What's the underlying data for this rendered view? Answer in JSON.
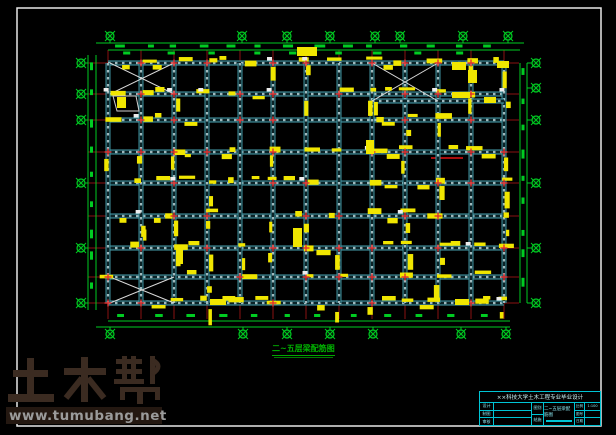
{
  "colors": {
    "background": "#000000",
    "frame": "#e8e8e8",
    "beam_edge": "#48a2b0",
    "beam_dark": "#0b2327",
    "beam_dash": "#9fb9bd",
    "axis_red": "#8a1212",
    "cross_red": "#e23030",
    "green": "#00cc22",
    "yellow": "#f0e600",
    "white_mark": "#ededed",
    "title_green": "#00b400",
    "cyan": "#00c4d4",
    "watermark_brown": "#3b2b21"
  },
  "plan": {
    "frame": {
      "x": 17,
      "y": 8,
      "w": 584,
      "h": 418
    },
    "cols": [
      108,
      141,
      174,
      207,
      240,
      273,
      306,
      339,
      372,
      405,
      438,
      471,
      504
    ],
    "rows": [
      63,
      94,
      120,
      152,
      183,
      216,
      248,
      277,
      303
    ],
    "extra_beams_h": [
      [
        372,
        504,
        101
      ]
    ],
    "red_segments": [
      [
        431,
        102,
        500,
        102
      ],
      [
        431,
        158,
        463,
        158
      ]
    ],
    "braces": [
      [
        110,
        63,
        174,
        94
      ],
      [
        372,
        63,
        438,
        101
      ],
      [
        110,
        277,
        174,
        303
      ]
    ],
    "outline_polys": [
      "M113,96 L136,96 L139,111 L117,111 Z"
    ],
    "bubbles": {
      "top_y": 36,
      "top_x": [
        110,
        242,
        287,
        330,
        375,
        400,
        463,
        508
      ],
      "bottom_y": 334,
      "bottom_x": [
        110,
        243,
        287,
        330,
        373,
        461,
        506
      ],
      "left_x": 81,
      "left_y": [
        63,
        94,
        120,
        183,
        248,
        303
      ],
      "right_x": 536,
      "right_y": [
        63,
        88,
        120,
        183,
        248,
        303
      ]
    },
    "dim": {
      "top": [
        43,
        50
      ],
      "bottom": [
        321,
        327
      ],
      "left": [
        88,
        96
      ],
      "right": [
        520,
        527
      ]
    },
    "extra_callouts": [
      [
        297,
        47,
        20,
        9
      ],
      [
        452,
        62,
        14,
        8
      ],
      [
        468,
        70,
        9,
        13
      ],
      [
        497,
        61,
        12,
        7
      ],
      [
        452,
        92,
        18,
        6
      ],
      [
        484,
        97,
        12,
        6
      ],
      [
        293,
        228,
        9,
        19
      ],
      [
        117,
        97,
        9,
        11
      ],
      [
        176,
        248,
        7,
        16
      ],
      [
        366,
        140,
        8,
        14
      ],
      [
        210,
        299,
        16,
        6
      ],
      [
        455,
        299,
        14,
        6
      ]
    ],
    "texture_seed": 123456
  },
  "drawing_title": {
    "text": "二~五层梁配筋图"
  },
  "watermark": {
    "title": "土木帮",
    "url": "www.tumubang.net"
  },
  "titleblock": {
    "header": "××科技大学土木工程专业毕业设计",
    "left_rows": [
      {
        "label": "设计",
        "value": ""
      },
      {
        "label": "制图",
        "value": ""
      },
      {
        "label": "审核",
        "value": ""
      }
    ],
    "mid_cells": [
      "图别",
      "结施"
    ],
    "main_title": "二~五层梁配筋图",
    "right_rows": [
      {
        "label": "比例",
        "value": "1:100"
      },
      {
        "label": "图号",
        "value": ""
      },
      {
        "label": "日期",
        "value": ""
      }
    ]
  }
}
